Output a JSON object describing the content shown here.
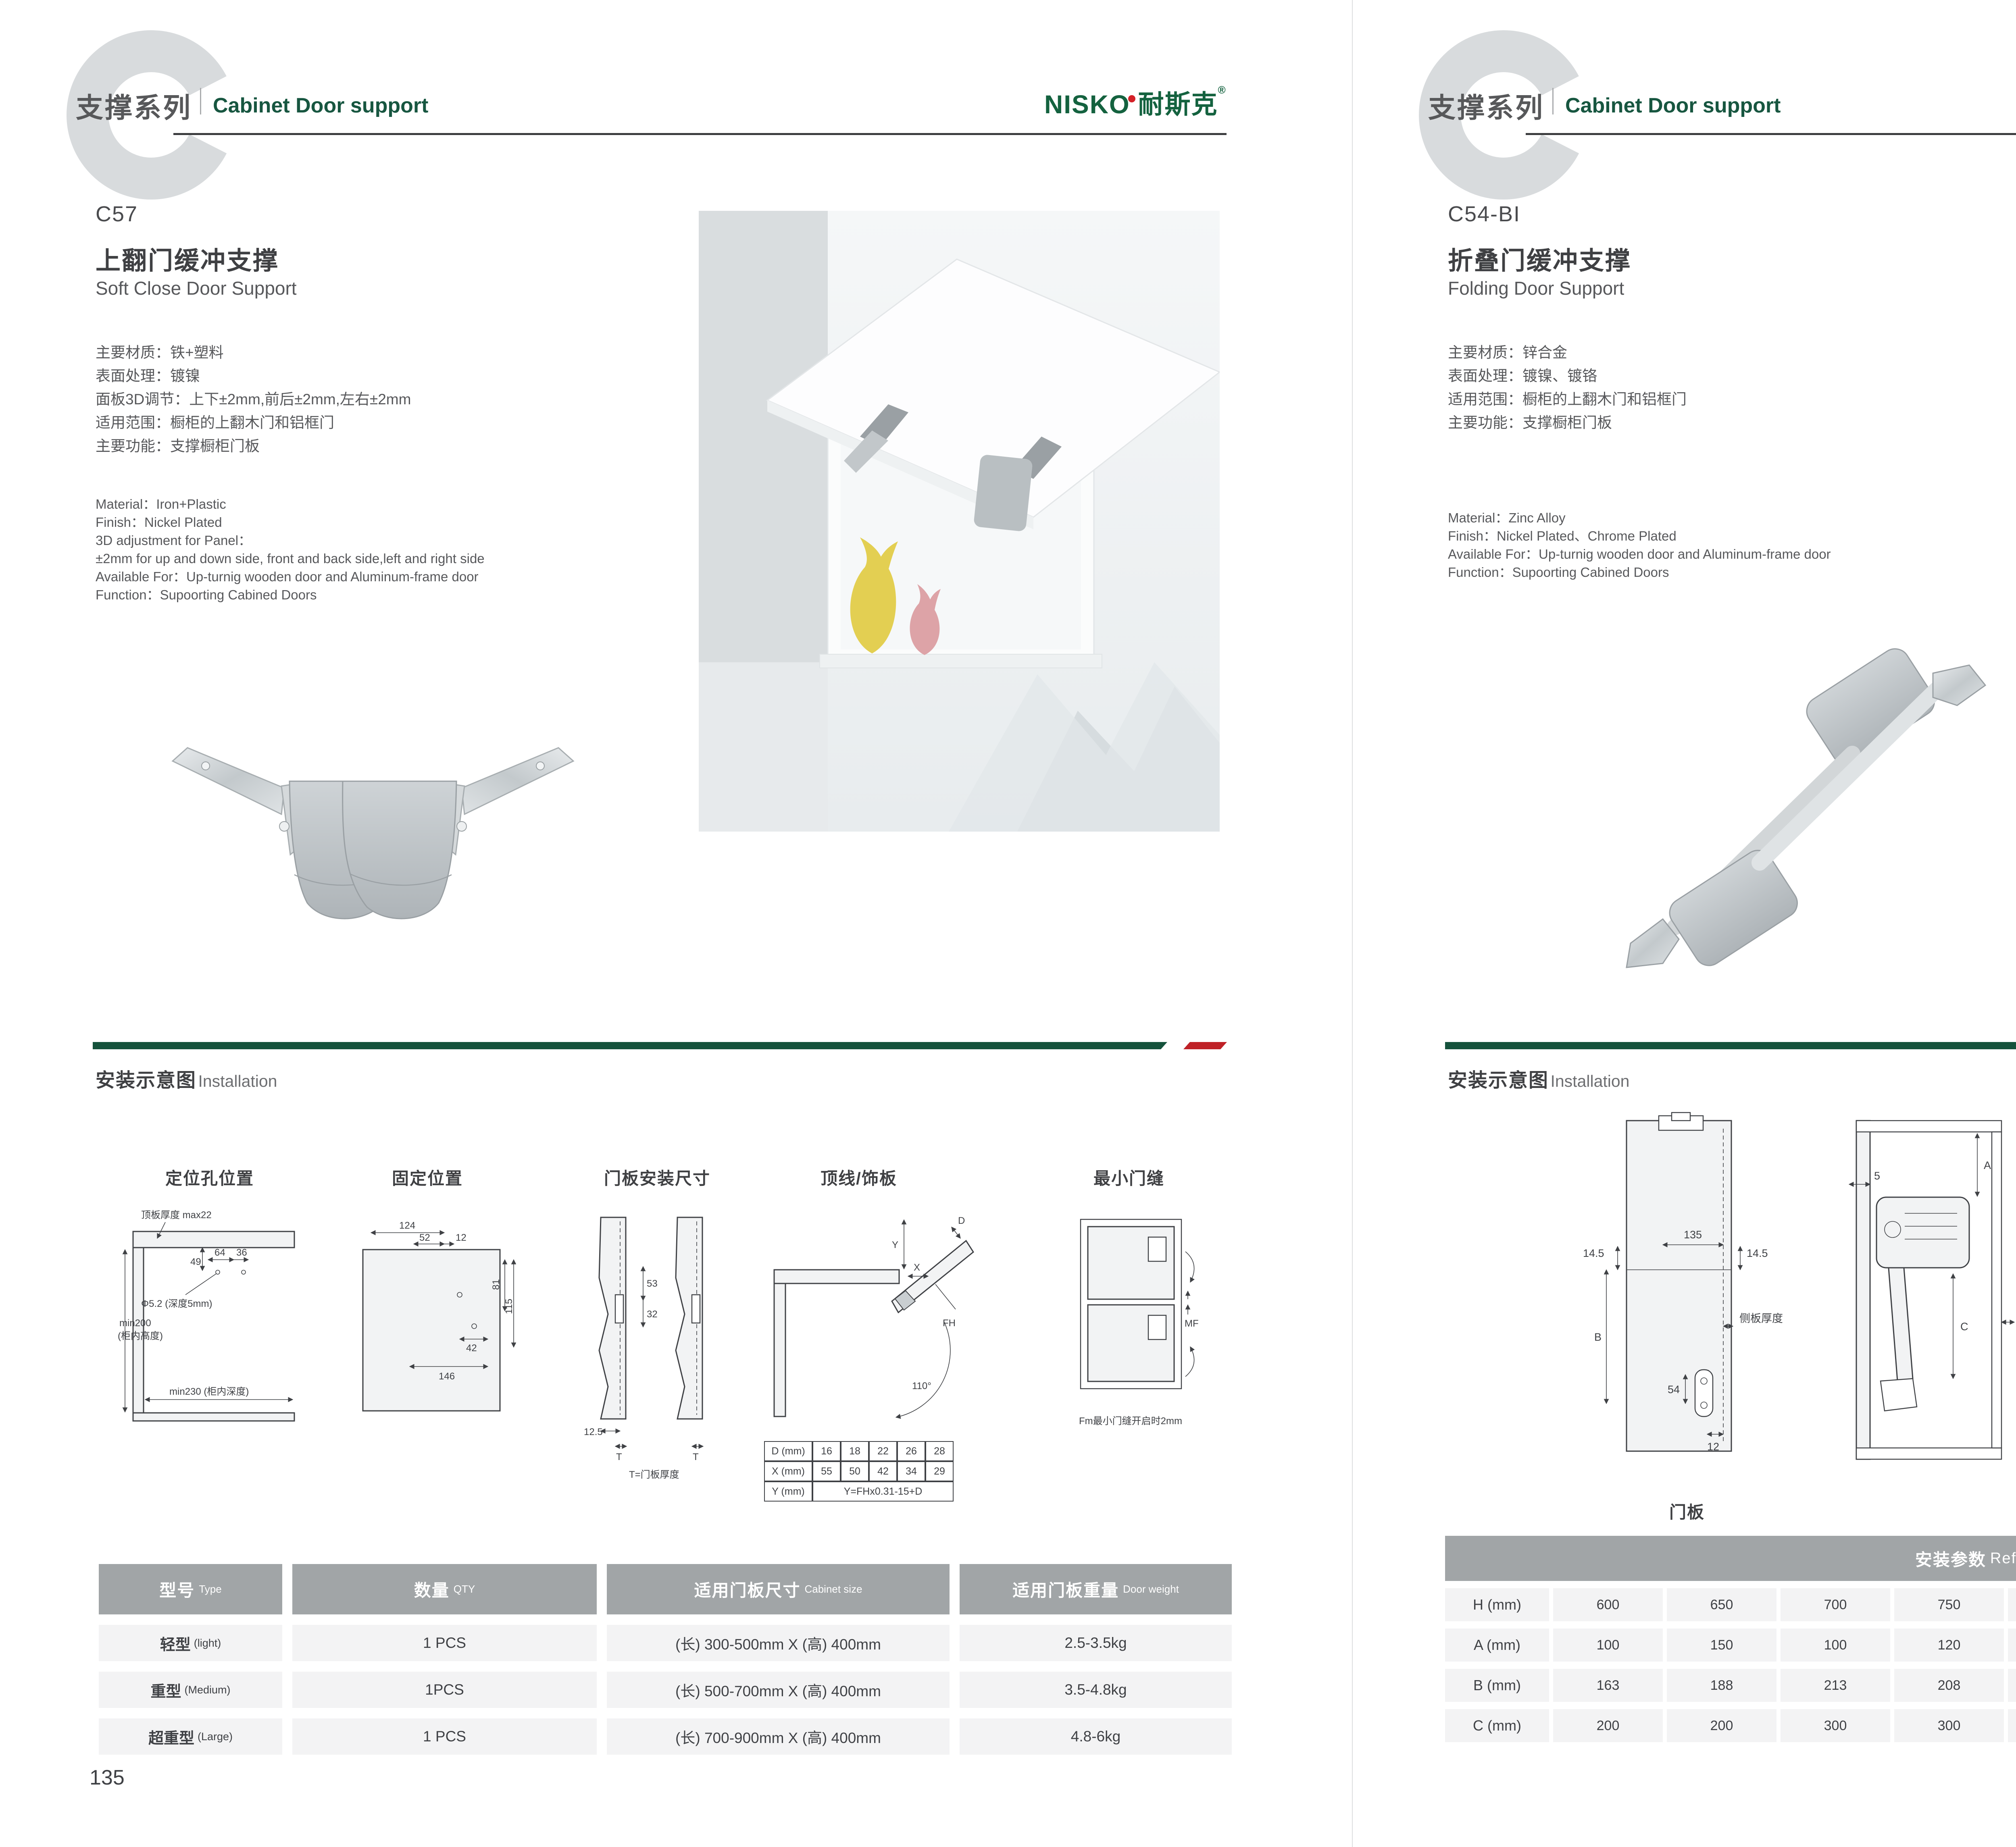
{
  "brand": {
    "logo_latin": "NISKO",
    "logo_cn": "耐斯克",
    "reg": "®"
  },
  "header": {
    "series_cn": "支撑系列",
    "series_en": "Cabinet Door support",
    "letter": "C"
  },
  "left": {
    "model": "C57",
    "title_cn": "上翻门缓冲支撑",
    "title_en": "Soft Close Door Support",
    "specs_cn": [
      "主要材质：铁+塑料",
      "表面处理：镀镍",
      "面板3D调节：上下±2mm,前后±2mm,左右±2mm",
      "适用范围：橱柜的上翻木门和铝框门",
      "主要功能：支撑橱柜门板"
    ],
    "specs_en": [
      "Material：Iron+Plastic",
      "Finish：Nickel Plated",
      "3D adjustment for Panel：",
      "±2mm for up and down side, front and back side,left and right side",
      "Available For：Up-turnig wooden door and Aluminum-frame door",
      "Function：Supoorting Cabined Doors"
    ],
    "install_cn": "安装示意图",
    "install_en": "Installation",
    "diagram_labels": [
      "定位孔位置",
      "固定位置",
      "门板安装尺寸",
      "顶线/饰板",
      "最小门缝"
    ],
    "d1": {
      "top_thickness": "顶板厚度 max22",
      "d49": "49",
      "d64": "64",
      "d36": "36",
      "hole": "Φ5.2 (深度5mm)",
      "min200": "min200",
      "cab_h": "(柜内高度)",
      "min230": "min230 (柜内深度)"
    },
    "d2": {
      "d124": "124",
      "d52": "52",
      "d12": "12",
      "d81": "81",
      "d115": "115",
      "d42": "42",
      "d146": "146"
    },
    "d3": {
      "d53": "53",
      "d32": "32",
      "d125": "12.5",
      "t1": "T",
      "t2": "T",
      "note": "T=门板厚度"
    },
    "d4": {
      "y": "Y",
      "x": "X",
      "d": "D",
      "fh": "FH",
      "angle": "110°"
    },
    "d5": {
      "mf": "MF",
      "note": "Fm最小门缝开启时2mm"
    },
    "mini_table": {
      "r1": [
        "D (mm)",
        "16",
        "18",
        "22",
        "26",
        "28"
      ],
      "r2": [
        "X (mm)",
        "55",
        "50",
        "42",
        "34",
        "29"
      ],
      "r3_label": "Y (mm)",
      "r3_value": "Y=FHx0.31-15+D"
    },
    "table": {
      "headers": [
        {
          "cn": "型号",
          "en": "Type"
        },
        {
          "cn": "数量",
          "en": "QTY"
        },
        {
          "cn": "适用门板尺寸",
          "en": "Cabinet size"
        },
        {
          "cn": "适用门板重量",
          "en": "Door weight"
        }
      ],
      "rows": [
        {
          "type_cn": "轻型",
          "type_en": "(light)",
          "qty": "1 PCS",
          "size": "(长) 300-500mm X (高) 400mm",
          "weight": "2.5-3.5kg"
        },
        {
          "type_cn": "重型",
          "type_en": "(Medium)",
          "qty": "1PCS",
          "size": "(长) 500-700mm X (高) 400mm",
          "weight": "3.5-4.8kg"
        },
        {
          "type_cn": "超重型",
          "type_en": "(Large)",
          "qty": "1 PCS",
          "size": "(长) 700-900mm X (高) 400mm",
          "weight": "4.8-6kg"
        }
      ]
    },
    "page_number": "135"
  },
  "right": {
    "model": "C54-BI",
    "title_cn": "折叠门缓冲支撑",
    "title_en": "Folding Door Support",
    "specs_cn": [
      "主要材质：锌合金",
      "表面处理：镀镍、镀铬",
      "适用范围：橱柜的上翻木门和铝框门",
      "主要功能：支撑橱柜门板"
    ],
    "specs_en": [
      "Material：Zinc Alloy",
      "Finish：Nickel Plated、Chrome Plated",
      "Available For：Up-turnig wooden door and Aluminum-frame door",
      "Function：Supoorting Cabined Doors"
    ],
    "install_cn": "安装示意图",
    "install_en": "Installation",
    "rd1": {
      "d135": "135",
      "d145r": "14.5",
      "d145l": "14.5",
      "b": "B",
      "side": "侧板厚度",
      "d54": "54",
      "d12": "12",
      "label": "门板"
    },
    "rd2": {
      "d5": "5",
      "a": "A",
      "c": "C",
      "d19": "19"
    },
    "rd3": {
      "d193": "193",
      "d102": "102",
      "d23": "23",
      "h": "H",
      "d50": "50"
    },
    "rd4": {
      "d24": "24",
      "d12": "12"
    },
    "table": {
      "title_cn": "安装参数",
      "title_en": "Reference Data",
      "row_h": {
        "label": "H (mm)",
        "values": [
          "600",
          "650",
          "700",
          "750",
          "800",
          "850",
          "900",
          "950",
          "1000"
        ]
      },
      "row_a": {
        "label": "A (mm)",
        "values": [
          "100",
          "150",
          "100",
          "120",
          "200",
          "250",
          "200",
          "250",
          "250"
        ]
      },
      "row_b": {
        "label": "B (mm)",
        "values": [
          "163",
          "188",
          "213",
          "208",
          "263",
          "288",
          "263",
          "288",
          "313"
        ]
      },
      "row_c": {
        "label": "C (mm)",
        "values": [
          "200",
          "200",
          "300",
          "300",
          "300",
          "300",
          "350",
          "350",
          "400"
        ]
      }
    },
    "page_number": "136"
  }
}
